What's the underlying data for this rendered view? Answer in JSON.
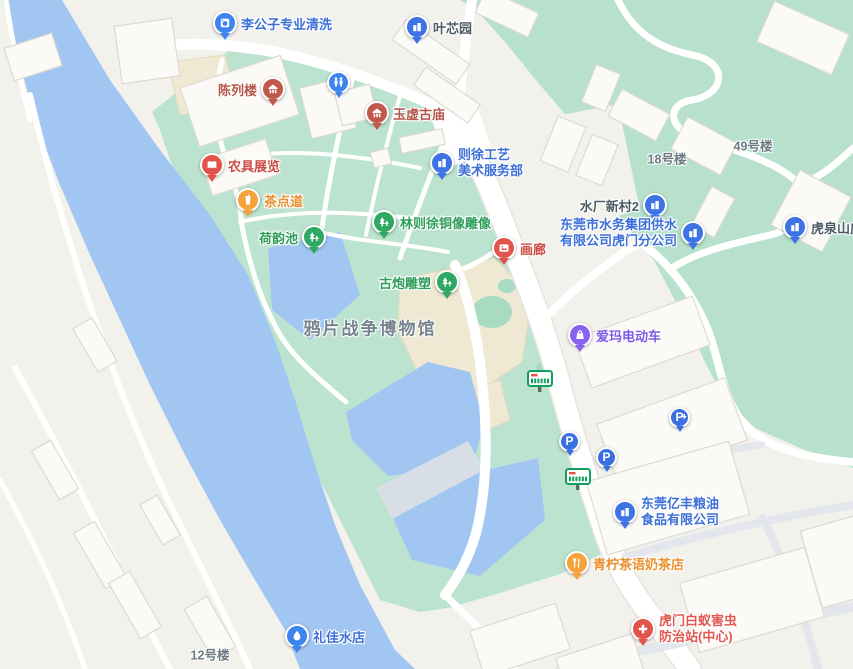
{
  "map": {
    "area_label": {
      "text": "鸦片战争博物馆"
    },
    "pois": [
      {
        "id": "ligongzi-cleaning",
        "label": "李公子专业清洗",
        "category": "services",
        "icon": "washing-machine-icon"
      },
      {
        "id": "yexinyuan",
        "label": "叶芯园",
        "category": "residence",
        "icon": "building-icon"
      },
      {
        "id": "chenlielou",
        "label": "陈列楼",
        "category": "heritage",
        "icon": "pavilion-icon"
      },
      {
        "id": "yuxu-temple",
        "label": "玉虚古庙",
        "category": "heritage",
        "icon": "pavilion-icon"
      },
      {
        "id": "zexu-arts",
        "line1": "则徐工艺",
        "line2": "美术服务部",
        "category": "company",
        "icon": "building-icon"
      },
      {
        "id": "nongju-exhibit",
        "label": "农具展览",
        "category": "exhibit",
        "icon": "open-book-icon"
      },
      {
        "id": "chadiandao",
        "label": "茶点道",
        "category": "food",
        "icon": "drink-cup-icon"
      },
      {
        "id": "shuichang-xincun",
        "label": "水厂新村2",
        "category": "residence",
        "icon": "building-icon"
      },
      {
        "id": "water-group",
        "line1": "东莞市水务集团供水",
        "line2": "有限公司虎门分公司",
        "category": "company",
        "icon": "building-icon"
      },
      {
        "id": "huquan-shanzhuang",
        "label": "虎泉山庄",
        "category": "residence",
        "icon": "building-icon"
      },
      {
        "id": "linzexu-statue",
        "label": "林则徐铜像雕像",
        "category": "park",
        "icon": "trees-icon"
      },
      {
        "id": "heyunchi",
        "label": "荷韵池",
        "category": "park",
        "icon": "trees-icon"
      },
      {
        "id": "hualang",
        "label": "画廊",
        "category": "exhibit",
        "icon": "picture-icon"
      },
      {
        "id": "gupao-sculpture",
        "label": "古炮雕塑",
        "category": "park",
        "icon": "trees-icon"
      },
      {
        "id": "aima-ebike",
        "label": "爱玛电动车",
        "category": "shopping",
        "icon": "shopping-bag-icon"
      },
      {
        "id": "yifeng-grain",
        "line1": "东莞亿丰粮油",
        "line2": "食品有限公司",
        "category": "company",
        "icon": "building-icon"
      },
      {
        "id": "qingning-tea",
        "label": "青柠茶语奶茶店",
        "category": "food",
        "icon": "fork-knife-icon"
      },
      {
        "id": "termite-station",
        "line1": "虎门白蚁害虫",
        "line2": "防治站(中心)",
        "category": "medical",
        "icon": "medical-cross-icon"
      },
      {
        "id": "lijia-water",
        "label": "礼佳水店",
        "category": "services",
        "icon": "water-drop-icon"
      },
      {
        "id": "bldg-18",
        "label": "18号楼",
        "category": "plain"
      },
      {
        "id": "bldg-49",
        "label": "49号楼",
        "category": "plain"
      },
      {
        "id": "bldg-12",
        "label": "12号楼",
        "category": "plain"
      }
    ],
    "markers": {
      "toilet": "toilet-icon",
      "bus_stops": [
        "bus-stop-icon",
        "bus-stop-icon"
      ],
      "parking": [
        "parking-icon",
        "parking-icon"
      ],
      "parking_charging": "parking-charging-icon"
    },
    "colors": {
      "land": "#F2F1EC",
      "park_green": "#BCE3CF",
      "hill_green": "#B7E1CC",
      "water_blue": "#A2C6F2",
      "pond_dam_gray": "#D8DEE6",
      "road_white": "#FFFFFF",
      "building_tan": "#EFE8D3",
      "poi_blue": "#3D6FD8",
      "poi_heritage_red": "#B4564A",
      "poi_red": "#CB4B42",
      "poi_orange": "#E8912F",
      "poi_green": "#2F9E5B",
      "poi_purple": "#7C5BE6",
      "poi_pink_red": "#E0584F",
      "residence_text": "#4D5C66",
      "plain_text": "#6E7A83",
      "area_text": "#76858E",
      "bus_green": "#12A05F",
      "parking_blue": "#3A6FE0"
    }
  }
}
